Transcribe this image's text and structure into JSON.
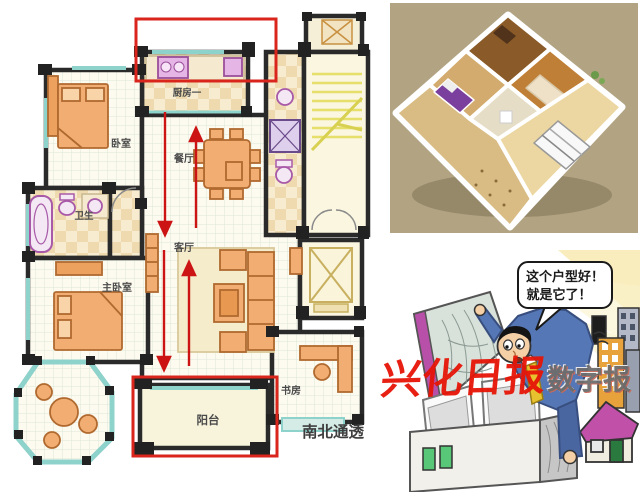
{
  "floor_plan": {
    "rooms": [
      {
        "id": "kitchen",
        "label": "厨房一"
      },
      {
        "id": "bedroom",
        "label": "卧室"
      },
      {
        "id": "dining",
        "label": "餐厅"
      },
      {
        "id": "bathroom",
        "label": "卫生"
      },
      {
        "id": "living",
        "label": "客厅"
      },
      {
        "id": "master-bedroom",
        "label": "主卧室"
      },
      {
        "id": "study",
        "label": "书房"
      },
      {
        "id": "balcony",
        "label": "阳台"
      }
    ],
    "caption": "南北通透",
    "highlight_color": "#d9251c",
    "arrow_color": "#cc1414"
  },
  "render_3d": {
    "background": "#b2a483"
  },
  "cartoon": {
    "speech": {
      "line1": "这个户型好！",
      "line2": "就是它了！"
    }
  },
  "watermark": {
    "main": "兴化日报",
    "suffix": "数字报",
    "main_color": "#e61507"
  }
}
